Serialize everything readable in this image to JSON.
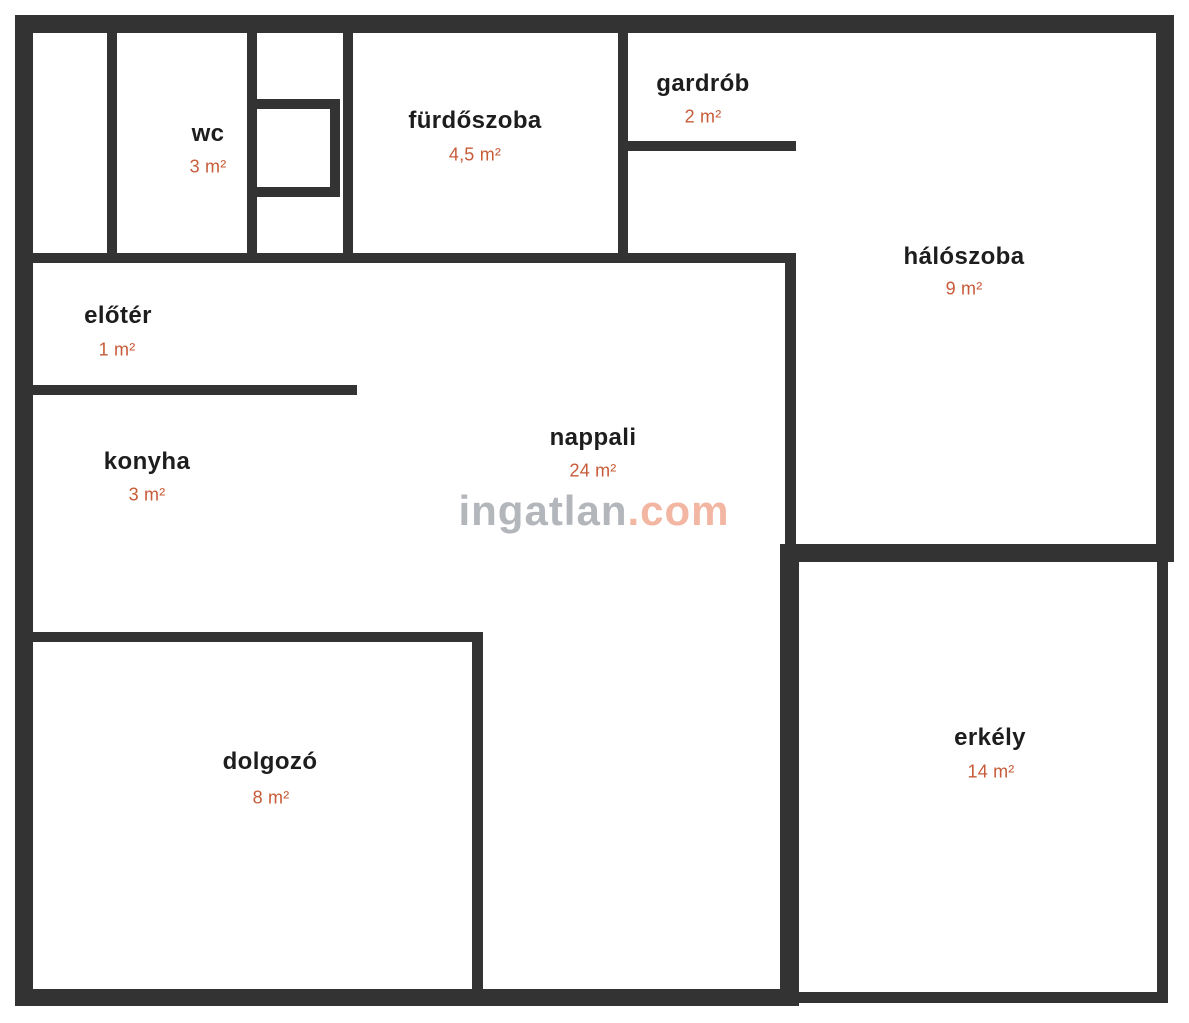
{
  "colors": {
    "wall": "#333333",
    "label": "#1d1d1d",
    "area": "#c75b38",
    "background": "#ffffff",
    "watermark_gray": "#b3b6bb",
    "watermark_salmon": "#f2b6a2"
  },
  "watermark": {
    "prefix": "ingatlan",
    "suffix": ".com"
  },
  "rooms": [
    {
      "id": "wc",
      "label": "wc",
      "area": "3 m²"
    },
    {
      "id": "furdoszoba",
      "label": "fürdőszoba",
      "area": "4,5 m²"
    },
    {
      "id": "gardrob",
      "label": "gardrób",
      "area": "2 m²"
    },
    {
      "id": "haloszoba",
      "label": "hálószoba",
      "area": "9 m²"
    },
    {
      "id": "eloter",
      "label": "előtér",
      "area": "1 m²"
    },
    {
      "id": "konyha",
      "label": "konyha",
      "area": "3 m²"
    },
    {
      "id": "nappali",
      "label": "nappali",
      "area": "24 m²"
    },
    {
      "id": "dolgozo",
      "label": "dolgozó",
      "area": "8 m²"
    },
    {
      "id": "erkely",
      "label": "erkély",
      "area": "14 m²"
    }
  ]
}
